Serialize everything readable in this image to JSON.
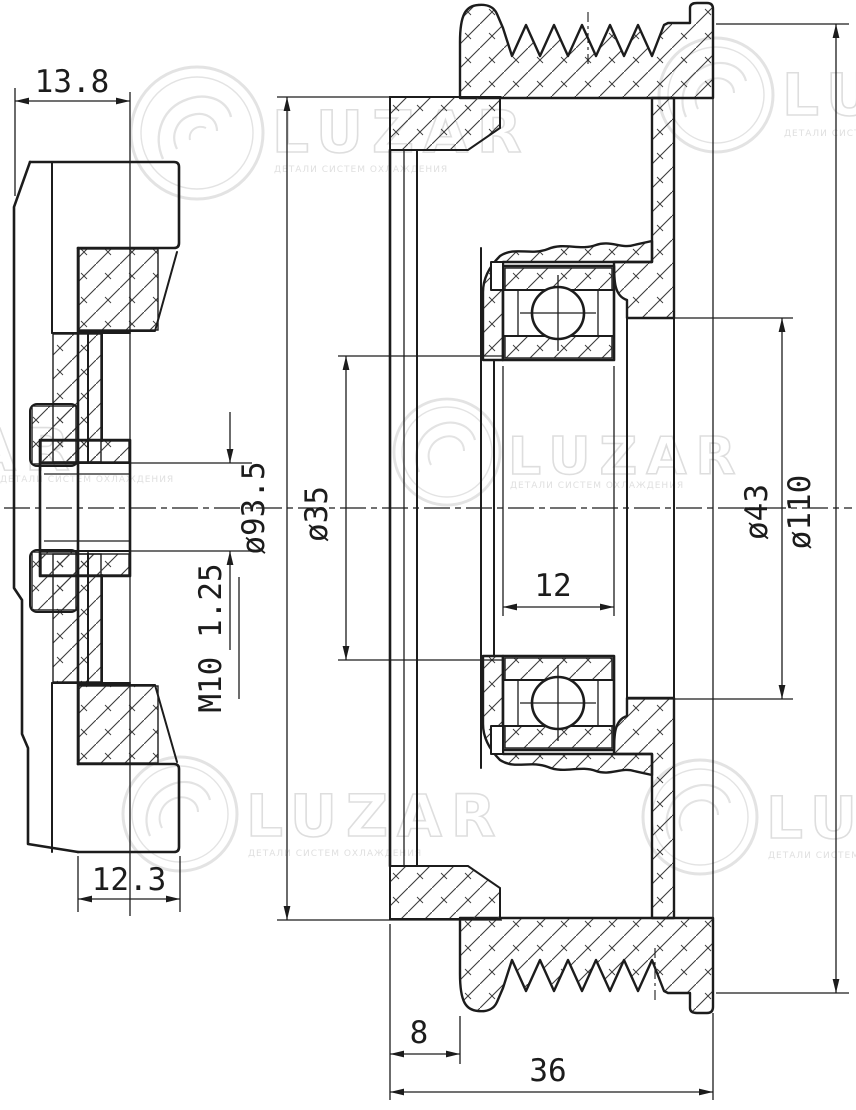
{
  "watermark": {
    "brand": "LUZAR",
    "subtitle": "ДЕТАЛИ СИСТЕМ ОХЛАЖДЕНИЯ"
  },
  "side_view": {
    "dims": {
      "top_width": "13.8",
      "bottom_width": "12.3",
      "thread": "M10 1.25"
    }
  },
  "section_view": {
    "dims": {
      "cover_dia": "ø93.5",
      "seat_dia": "ø35",
      "bearing_width": "12",
      "hub_dia": "ø43",
      "outer_dia": "ø110",
      "cover_offset": "8",
      "overall_width": "36"
    }
  },
  "colors": {
    "line": "#1c1c1c",
    "watermark": "#e3e3e3",
    "background": "#ffffff"
  }
}
